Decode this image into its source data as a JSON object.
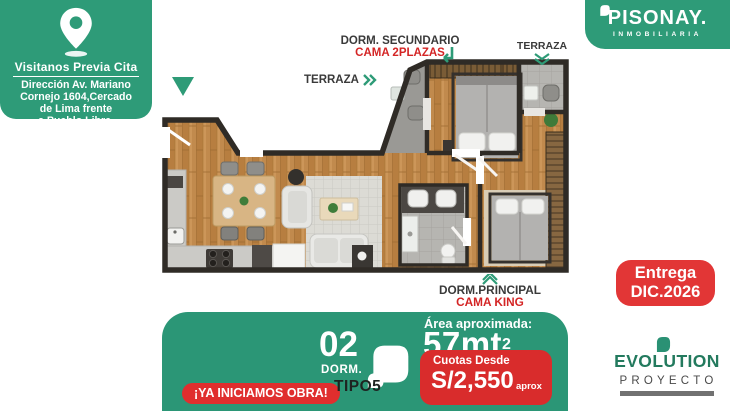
{
  "brand": {
    "name": "PISONAY.",
    "tagline": "INMOBILIARIA",
    "colors": {
      "green": "#2E9B78",
      "panel_green": "#2B9676",
      "red": "#E23636",
      "dark_text": "#3A3A3A"
    }
  },
  "visit_card": {
    "title": "Visitanos Previa Cita",
    "address_lines": [
      "Dirección Av. Mariano",
      "Cornejo 1604,Cercado",
      "de Lima frente",
      "a Pueblo Libre."
    ]
  },
  "floor_plan": {
    "labels": {
      "terraza_left": "TERRAZA",
      "dorm_secundario": "DORM. SECUNDARIO",
      "cama_secundario": "CAMA 2PLAZAS",
      "terraza_right": "TERRAZA",
      "dorm_principal": "DORM.PRINCIPAL",
      "cama_principal": "CAMA KING"
    }
  },
  "delivery_badge": {
    "line1": "Entrega",
    "line2": "DIC.2026"
  },
  "offer_panel": {
    "cta": "¡YA INICIAMOS OBRA!",
    "unit_number": "02",
    "unit_label": "DORM.",
    "unit_type": "TIPO5",
    "area_label": "Área aproximada:",
    "area_value": "57mt",
    "area_sup": "2",
    "price_label": "Cuotas Desde",
    "price_value": "S/2,550",
    "price_suffix": "aprox"
  },
  "project_logo": {
    "name": "EVOLUTION",
    "subtitle": "PROYECTO"
  }
}
